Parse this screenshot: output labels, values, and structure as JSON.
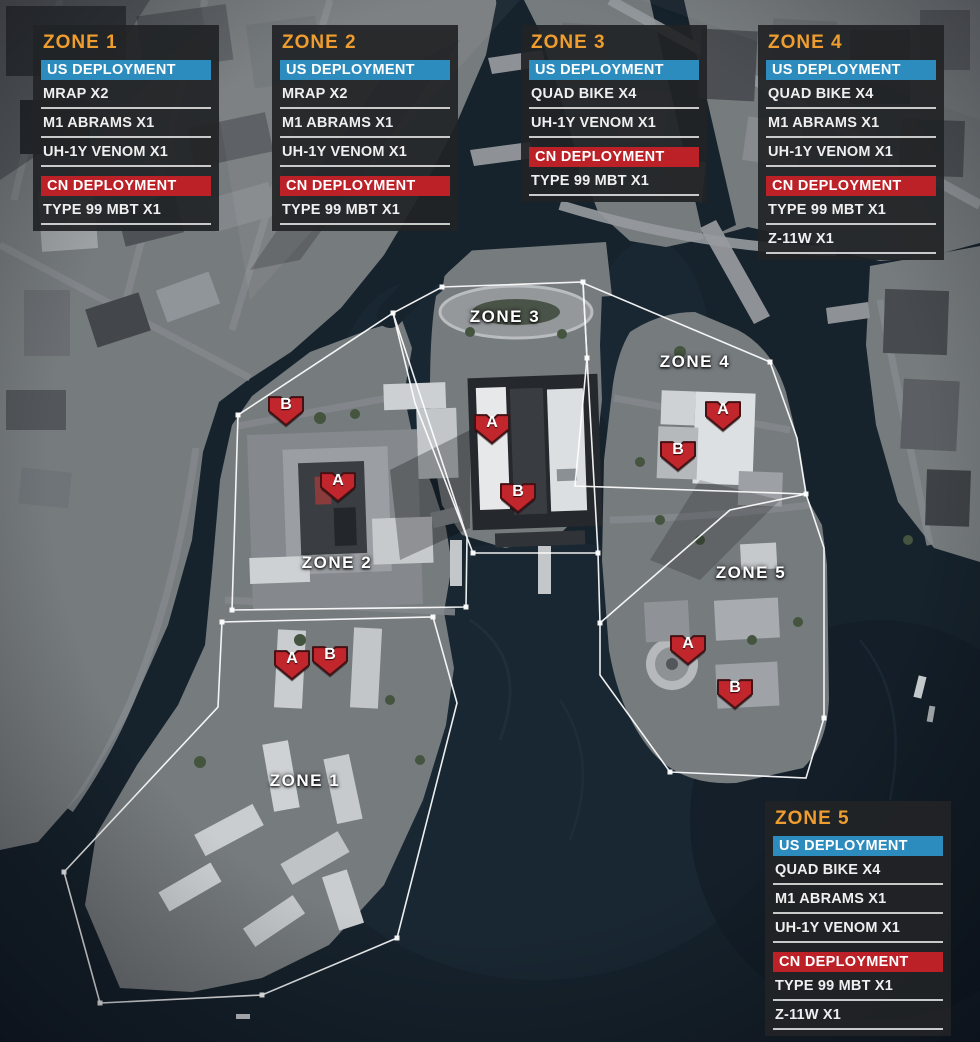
{
  "panels": [
    {
      "zone": "ZONE 1",
      "us_header": "US DEPLOYMENT",
      "cn_header": "CN DEPLOYMENT",
      "us_items": [
        "MRAP X2",
        "M1 ABRAMS X1",
        "UH-1Y VENOM X1"
      ],
      "cn_items": [
        "TYPE 99 MBT X1"
      ]
    },
    {
      "zone": "ZONE 2",
      "us_header": "US DEPLOYMENT",
      "cn_header": "CN DEPLOYMENT",
      "us_items": [
        "MRAP X2",
        "M1 ABRAMS X1",
        "UH-1Y VENOM X1"
      ],
      "cn_items": [
        "TYPE 99 MBT X1"
      ]
    },
    {
      "zone": "ZONE 3",
      "us_header": "US DEPLOYMENT",
      "cn_header": "CN DEPLOYMENT",
      "us_items": [
        "QUAD BIKE X4",
        "UH-1Y VENOM X1"
      ],
      "cn_items": [
        "TYPE 99 MBT X1"
      ]
    },
    {
      "zone": "ZONE 4",
      "us_header": "US DEPLOYMENT",
      "cn_header": "CN DEPLOYMENT",
      "us_items": [
        "QUAD BIKE X4",
        "M1 ABRAMS X1",
        "UH-1Y VENOM X1"
      ],
      "cn_items": [
        "TYPE 99 MBT X1",
        "Z-11W X1"
      ]
    },
    {
      "zone": "ZONE 5",
      "us_header": "US DEPLOYMENT",
      "cn_header": "CN DEPLOYMENT",
      "us_items": [
        "QUAD BIKE X4",
        "M1 ABRAMS X1",
        "UH-1Y VENOM X1"
      ],
      "cn_items": [
        "TYPE 99 MBT X1",
        "Z-11W X1"
      ]
    }
  ],
  "map": {
    "zone_labels": [
      {
        "text": "ZONE 1"
      },
      {
        "text": "ZONE 2"
      },
      {
        "text": "ZONE 3"
      },
      {
        "text": "ZONE 4"
      },
      {
        "text": "ZONE 5"
      }
    ],
    "markers": [
      {
        "zone": "ZONE 1",
        "letter": "A"
      },
      {
        "zone": "ZONE 1",
        "letter": "B"
      },
      {
        "zone": "ZONE 2",
        "letter": "A"
      },
      {
        "zone": "ZONE 2",
        "letter": "B"
      },
      {
        "zone": "ZONE 3",
        "letter": "A"
      },
      {
        "zone": "ZONE 3",
        "letter": "B"
      },
      {
        "zone": "ZONE 4",
        "letter": "A"
      },
      {
        "zone": "ZONE 4",
        "letter": "B"
      },
      {
        "zone": "ZONE 5",
        "letter": "A"
      },
      {
        "zone": "ZONE 5",
        "letter": "B"
      }
    ]
  },
  "colors": {
    "zone_title_orange": "#EE9D2E",
    "us_deployment_blue": "#2D8CBE",
    "cn_deployment_red": "#BB2127",
    "marker_red": "#C0262C",
    "boundary_white": "#FFFFFF",
    "water_dark": "#16222C"
  }
}
